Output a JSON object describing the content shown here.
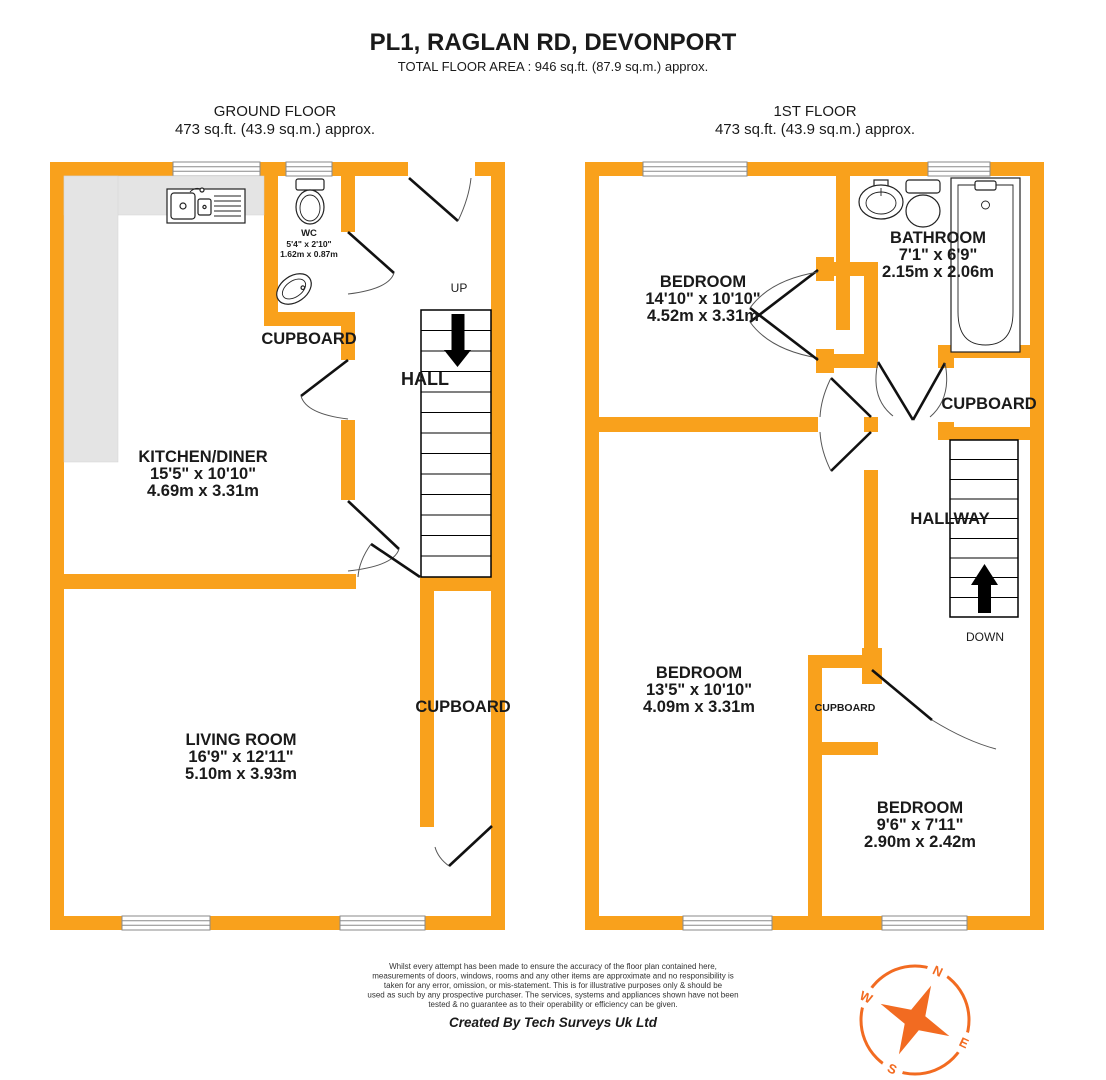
{
  "page": {
    "title": "PL1, RAGLAN RD, DEVONPORT",
    "subtitle": "TOTAL FLOOR AREA : 946 sq.ft. (87.9 sq.m.) approx."
  },
  "ground_floor": {
    "label": "GROUND FLOOR",
    "area": "473 sq.ft. (43.9 sq.m.) approx.",
    "kitchen": {
      "name": "KITCHEN/DINER",
      "imperial": "15'5\"  x 10'10\"",
      "metric": "4.69m  x 3.31m"
    },
    "living": {
      "name": "LIVING ROOM",
      "imperial": "16'9\"  x 12'11\"",
      "metric": "5.10m  x 3.93m"
    },
    "wc": {
      "name": "WC",
      "imperial": "5'4\"  x 2'10\"",
      "metric": "1.62m  x 0.87m"
    },
    "hall": "HALL",
    "up": "UP",
    "cupboard_wc": "CUPBOARD",
    "cupboard_stairs": "CUPBOARD"
  },
  "first_floor": {
    "label": "1ST FLOOR",
    "area": "473 sq.ft. (43.9 sq.m.) approx.",
    "bedroom1": {
      "name": "BEDROOM",
      "imperial": "14'10\"  x 10'10\"",
      "metric": "4.52m  x 3.31m"
    },
    "bedroom2": {
      "name": "BEDROOM",
      "imperial": "13'5\"  x 10'10\"",
      "metric": "4.09m  x 3.31m"
    },
    "bedroom3": {
      "name": "BEDROOM",
      "imperial": "9'6\"  x 7'11\"",
      "metric": "2.90m  x 2.42m"
    },
    "bathroom": {
      "name": "BATHROOM",
      "imperial": "7'1\"  x 6'9\"",
      "metric": "2.15m  x 2.06m"
    },
    "hallway": "HALLWAY",
    "down": "DOWN",
    "cupboard": "CUPBOARD",
    "cupboard_small": "CUPBOARD"
  },
  "footer": {
    "disclaimer_lines": [
      "Whilst every attempt has been made to ensure the accuracy of the floor plan contained here,",
      "measurements of doors, windows, rooms and any other items are approximate and no responsibility is",
      "taken for any error, omission, or mis-statement. This is for illustrative purposes only & should be",
      "used as such by any prospective purchaser. The services, systems and appliances shown have not been",
      "tested & no guarantee as to their operability or efficiency can be given."
    ],
    "credit": "Created By Tech Surveys Uk Ltd"
  },
  "compass": {
    "n": "N",
    "e": "E",
    "s": "S",
    "w": "W"
  },
  "colors": {
    "wall": "#F9A11C",
    "counter": "#E4E4E4",
    "compass": "#F26B21"
  }
}
